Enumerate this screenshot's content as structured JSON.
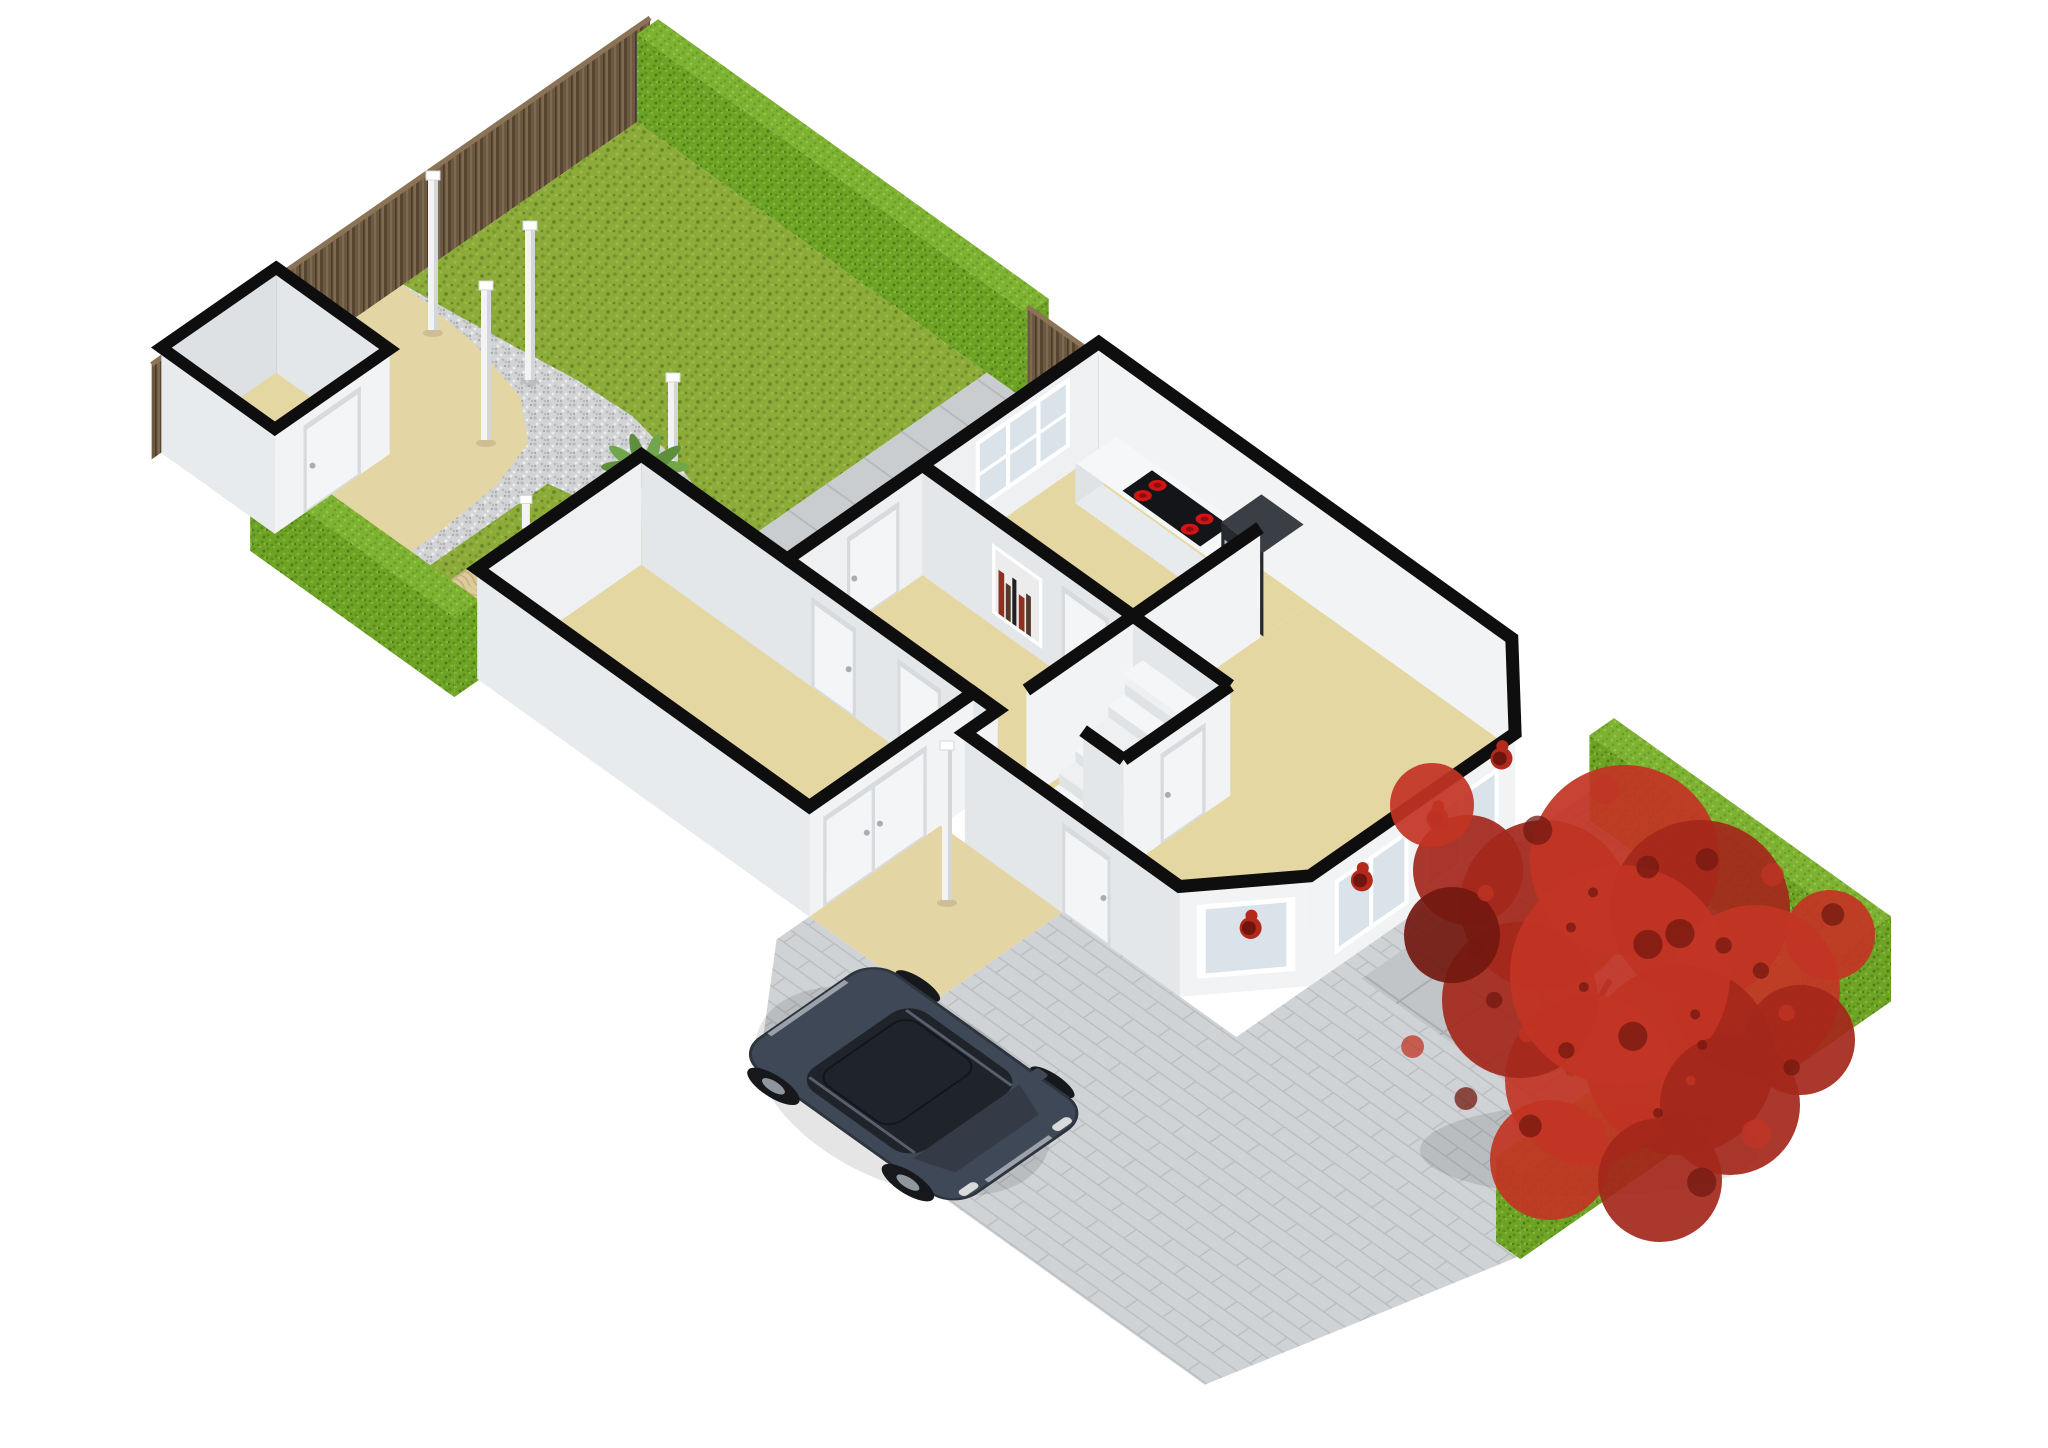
{
  "meta": {
    "kind": "3d-floorplan-rendering",
    "view": "isometric",
    "floor": "ground-floor-with-garden"
  },
  "objects": {
    "labels": [
      "back garden lawn",
      "gravel path",
      "patio",
      "sandbox",
      "palm tree",
      "garden shed",
      "wooden fence",
      "garden hedge",
      "terrace tiles",
      "kitchen",
      "cooktop",
      "oven unit",
      "kitchen window",
      "hallway",
      "meter cupboard with books",
      "interior doors",
      "stairs",
      "living room",
      "bay windows",
      "indoor red plants",
      "storage room",
      "double doors",
      "front door",
      "front path",
      "lamp posts",
      "driveway",
      "suv car",
      "ornamental red tree",
      "front garden hedge",
      "front garden paving"
    ]
  },
  "colors": {
    "white": "#ffffff",
    "wallTop": "#0e0e0f",
    "wallBright": "#f2f3f5",
    "wallLight": "#eef0f2",
    "wallMid": "#e4e7ea",
    "wallShade": "#dde1e4",
    "wallInner": "#e8ebed",
    "floor": "#e5d7a2",
    "patio": "#e4d5a5",
    "grass": "#8cab39",
    "grassDark": "#76922c",
    "grassLight": "#9db84e",
    "grassDeep": "#69862a",
    "hedge": "#6fa326",
    "hedgeDark": "#5b8d1d",
    "hedgeLight": "#82b838",
    "hedgeDeep": "#4e7d18",
    "hedgeTop": "#7fb232",
    "hedgeTopLight": "#91c544",
    "hedgeTopDark": "#6aa026",
    "wood": "#6d5942",
    "woodDark": "#57452f",
    "woodLight": "#7e6a4f",
    "woodDeep": "#4d3c29",
    "woodEdge": "#8a7356",
    "gravel": "#d2d4d6",
    "gravelDark": "#b8babc",
    "gravelLight": "#eceded",
    "gravelDeep": "#a9acae",
    "sand": "#dccb9b",
    "sandLine": "#c4b185",
    "tile": "#c9cdcf",
    "tileGrout": "#b5b9bb",
    "pave": "#cfd3d5",
    "paveGrout": "#babec0",
    "tileDark": "#c1c5c7",
    "tileDarkGrout": "#a8acae",
    "doorFrame": "#d8dbde",
    "doorWhite": "#f4f5f7",
    "handle": "#a9adb1",
    "glass": "#d9e3e9",
    "counterFront": "#e8ebed",
    "counterTop": "#f6f7f9",
    "counterEnd": "#dfe3e5",
    "stove": "#141518",
    "burner": "#d31414",
    "burnerCore": "#8c0d0d",
    "appliance": "#26292e",
    "applianceTop": "#3a3e45",
    "steel": "#aeb4ba",
    "post": "#f3f3f3",
    "postShade": "#d4d7d9",
    "bookRed": "#8f3122",
    "bookBrown": "#53392a",
    "bookBlack": "#1f2022",
    "stepTop": "#f5f6f7",
    "stepAlt": "#eef0f1",
    "stepRiser": "#e0e3e6",
    "flower": "#b5291c",
    "flowerDark": "#6e150d",
    "carBody": "#3f4856",
    "carDark": "#2d343f",
    "carGlass": "#1f242b",
    "carGlassLight": "#343b47",
    "carTrim": "#9aa1aa",
    "carLight": "#d8dadc",
    "wheel": "#16181b",
    "rim": "#8f969e",
    "treeRed": "#a4271b",
    "treeBright": "#c23424",
    "treeDark": "#731810",
    "trunk": "#3c2b20",
    "palm": "#5d8f3d",
    "palmDark": "#4a7a2e",
    "palmLight": "#71a74a",
    "shadow": "rgba(0,0,0,0.10)"
  }
}
